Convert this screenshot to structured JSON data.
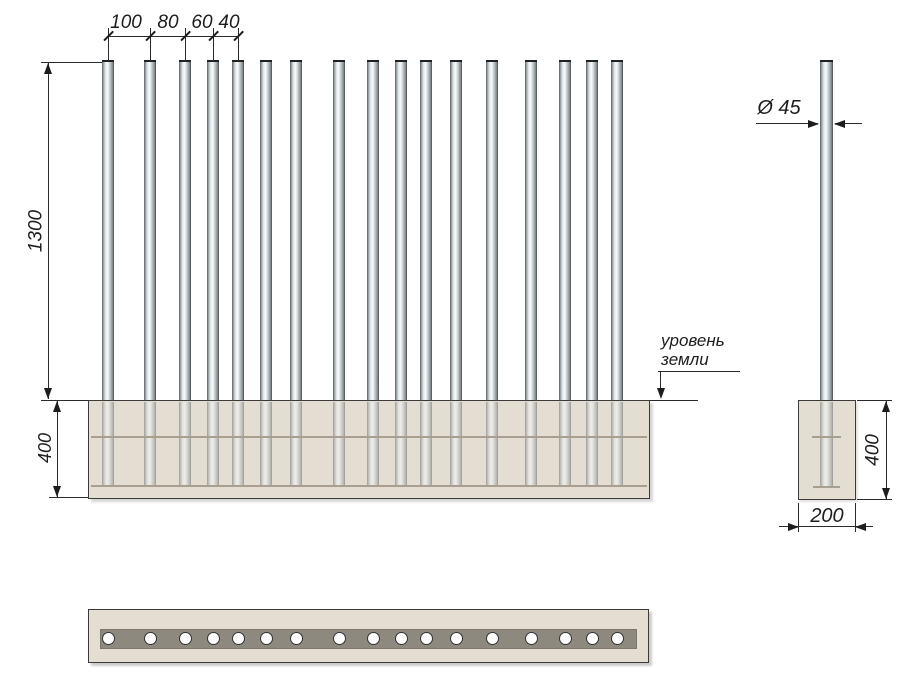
{
  "front_view": {
    "spacing_dims": [
      {
        "label": "100"
      },
      {
        "label": "80"
      },
      {
        "label": "60"
      },
      {
        "label": "40"
      }
    ],
    "height_dim_label": "1300",
    "embed_depth_label": "400",
    "ground_level_label_line1": "уровень",
    "ground_level_label_line2": "земли",
    "pole_count": 17,
    "pole_centers_px": [
      108,
      150,
      185,
      213,
      238,
      266,
      296,
      339,
      373,
      401,
      426,
      456,
      492,
      531,
      565,
      592,
      617
    ]
  },
  "side_view": {
    "diameter_label": "Ø 45",
    "embed_depth_label": "400",
    "foundation_width_label": "200"
  },
  "plan_view": {
    "hole_count": 17
  },
  "colors": {
    "concrete": "#e4ded2",
    "strip": "#8d897e",
    "line": "#2b2b2b",
    "pole_light": "#fafcfc",
    "pole_dark": "#4e5356"
  }
}
